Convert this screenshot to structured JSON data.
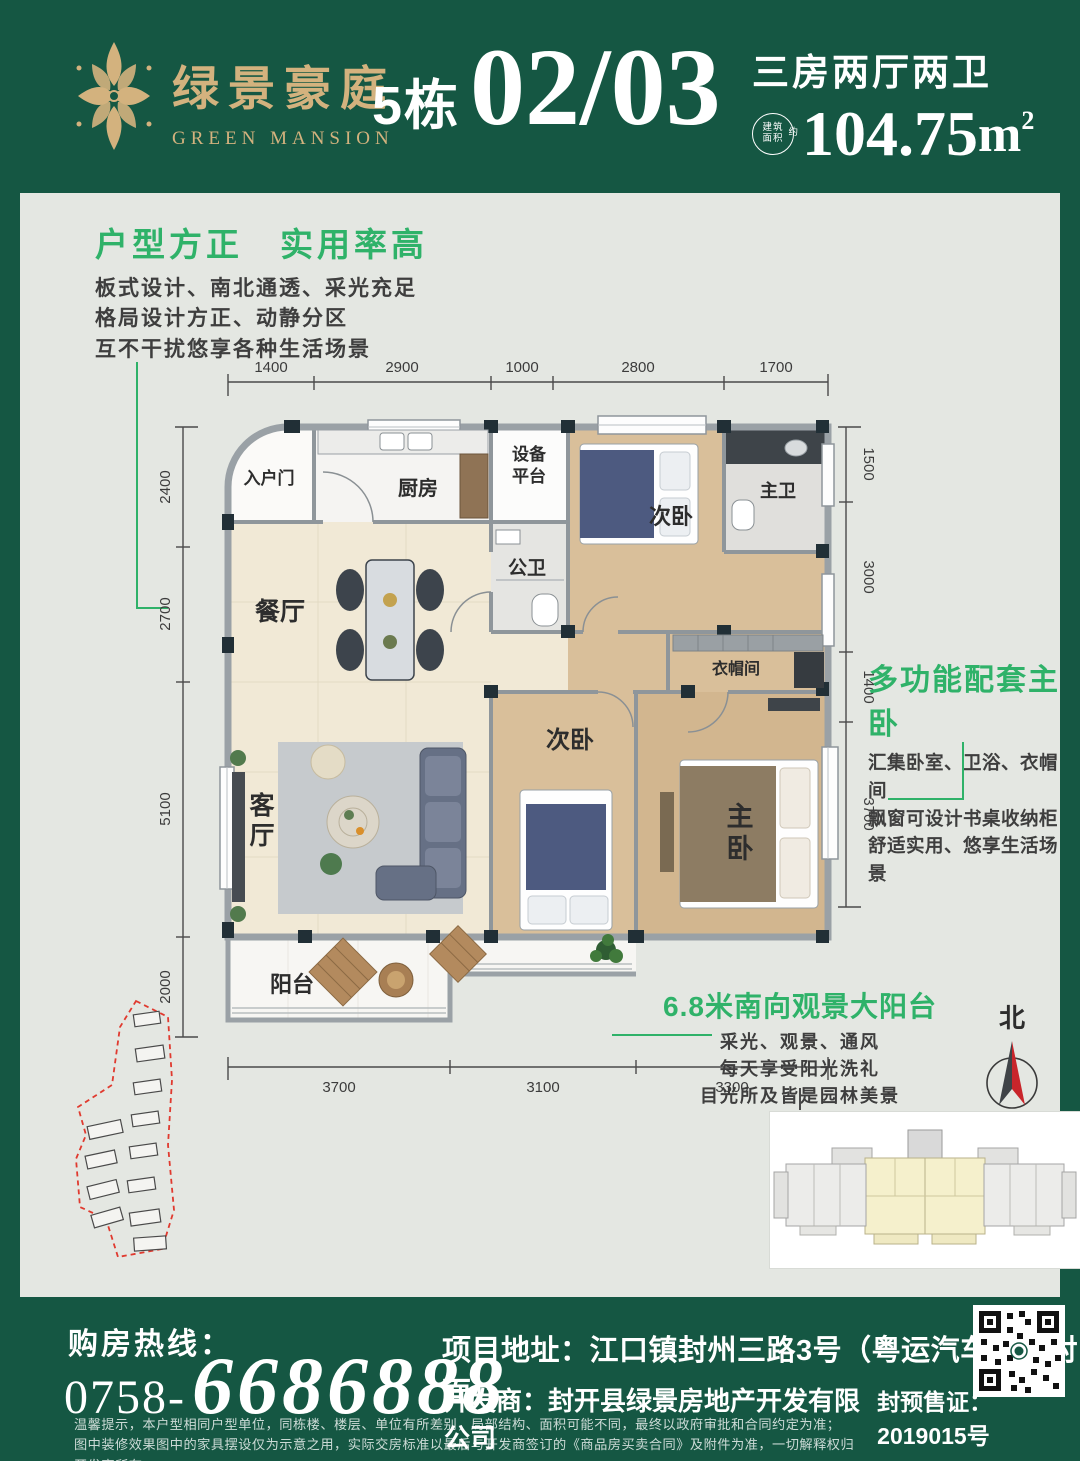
{
  "header": {
    "logo_cn": "绿景豪庭",
    "logo_en": "GREEN MANSION",
    "building": "5栋",
    "unit_no": "02/03",
    "spec": "三房两厅两卫",
    "area_badge_l1": "建筑",
    "area_badge_l2": "面积",
    "area_badge_approx": "约",
    "area_value": "104.75",
    "area_unit": "m",
    "area_sup": "2"
  },
  "selling_points": {
    "sp1": {
      "title": "户型方正　实用率高",
      "lines": [
        "板式设计、南北通透、采光充足",
        "格局设计方正、动静分区",
        "互不干扰悠享各种生活场景"
      ]
    },
    "sp2": {
      "title": "多功能配套主卧",
      "lines": [
        "汇集卧室、卫浴、衣帽间",
        "飘窗可设计书桌收纳柜",
        "舒适实用、悠享生活场景"
      ]
    },
    "sp3": {
      "title": "6.8米南向观景大阳台",
      "lines": [
        "采光、观景、通风",
        "每天享受阳光洗礼",
        "目光所及皆是园林美景"
      ]
    }
  },
  "plan": {
    "rooms": {
      "entry": "入户门",
      "kitchen": "厨房",
      "equip_l1": "设备",
      "equip_l2": "平台",
      "guest_bath": "公卫",
      "bed2": "次卧",
      "master_bath": "主卫",
      "dining": "餐厅",
      "closet": "衣帽间",
      "living_l1": "客",
      "living_l2": "厅",
      "bed3": "次卧",
      "master_l1": "主",
      "master_l2": "卧",
      "balcony": "阳台"
    },
    "dims": {
      "top": [
        "1400",
        "2900",
        "1000",
        "2800",
        "1700"
      ],
      "left": [
        "2400",
        "2700",
        "5100",
        "2000"
      ],
      "right": [
        "1500",
        "3000",
        "1400",
        "3700"
      ],
      "bottom": [
        "3700",
        "3100",
        "3300"
      ]
    }
  },
  "compass": {
    "north_label": "北"
  },
  "footer": {
    "hotline_label": "购房热线：",
    "hotline_prefix": "0758-",
    "hotline_number": "6686888",
    "address": "项目地址：江口镇封州三路3号（粤运汽车站斜对面）",
    "developer": "开发商：封开县绿景房地产开发有限公司",
    "license": "封预售证：2019015号",
    "disclaimer1": "温馨提示，本户型相同户型单位，同栋楼、楼层、单位有所差别，局部结构、面积可能不同，最终以政府审批和合同约定为准；",
    "disclaimer2": "图中装修效果图中的家具摆设仅为示意之用，实际交房标准以最后与开发商签订的《商品房买卖合同》及附件为准，一切解释权归开发商所有。"
  },
  "colors": {
    "brand_green": "#155743",
    "accent_green": "#2fb269",
    "gold": "#d3b27e",
    "compass_red": "#c9252b",
    "site_boundary_red": "#e03a2f",
    "keyplan_highlight": "#f5f0cc"
  }
}
